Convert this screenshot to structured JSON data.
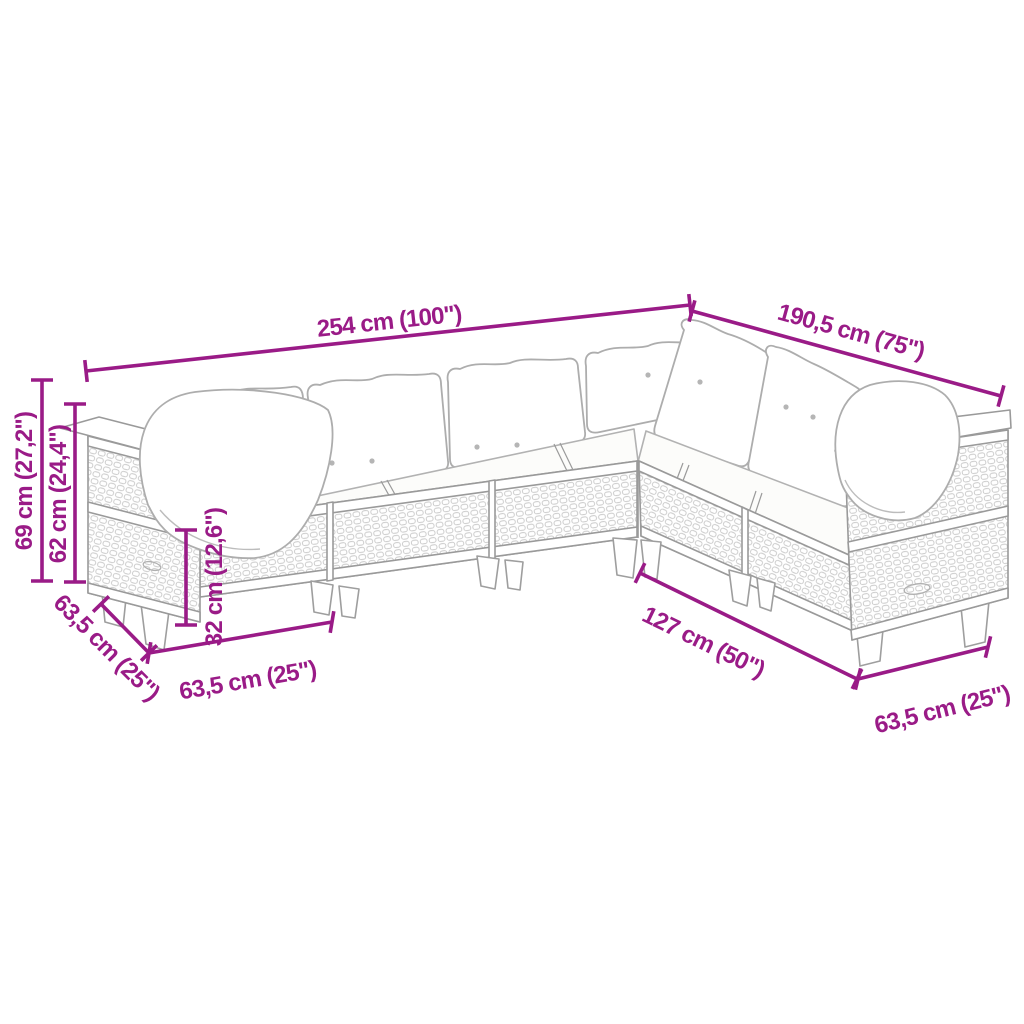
{
  "diagram": {
    "type": "furniture-dimension-diagram",
    "subject": "L-shaped rattan garden lounge sofa set with cushions",
    "colors": {
      "dimension_accent": "#9a1b87",
      "drawing_outline": "#a8a8a8",
      "wicker_texture": "#c7c7c7",
      "background": "#ffffff"
    },
    "dimensions": [
      {
        "id": "total-width-left-run",
        "label": "254 cm (100\")"
      },
      {
        "id": "total-width-right-run",
        "label": "190,5 cm (75\")"
      },
      {
        "id": "total-height",
        "label": "69 cm (27,2\")"
      },
      {
        "id": "back-height",
        "label": "62 cm (24,4\")"
      },
      {
        "id": "seat-height",
        "label": "32 cm (12,6\")"
      },
      {
        "id": "depth-left",
        "label": "63,5 cm (25\")"
      },
      {
        "id": "module-width-left",
        "label": "63,5 cm (25\")"
      },
      {
        "id": "inner-length-right",
        "label": "127 cm (50\")"
      },
      {
        "id": "module-width-right",
        "label": "63,5 cm (25\")"
      }
    ]
  }
}
